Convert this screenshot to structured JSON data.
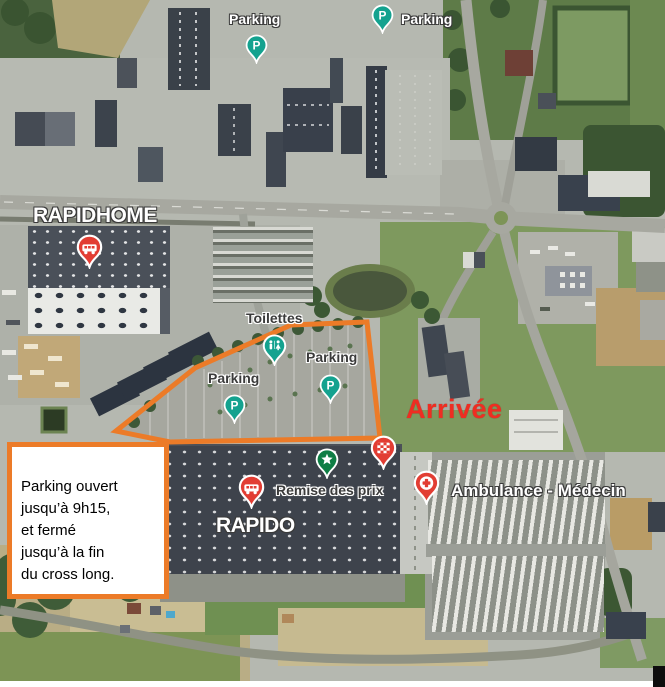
{
  "labels": {
    "parking_top_left": "Parking",
    "parking_top_right": "Parking",
    "rapidhome": "RAPIDHOME",
    "toilettes": "Toilettes",
    "parking_mid_left": "Parking",
    "parking_mid_right": "Parking",
    "arrivee": "Arrivée",
    "remise_des_prix": "Remise des prix",
    "rapido": "RAPIDO",
    "ambulance": "Ambulance - Médecin"
  },
  "notice": {
    "text": "Parking ouvert\njusqu’à 9h15,\net fermé\njusqu’à la fin\ndu cross long."
  },
  "pins": {
    "parking_letter": "P"
  },
  "colors": {
    "accent_orange": "#EC7B28",
    "arrival_red": "#EE2D22",
    "pin_teal": "#14A28F",
    "pin_green": "#0F7E45",
    "pin_red": "#E23D33",
    "label_dark": "#3B3B3B",
    "label_white": "#FFFFFF"
  }
}
